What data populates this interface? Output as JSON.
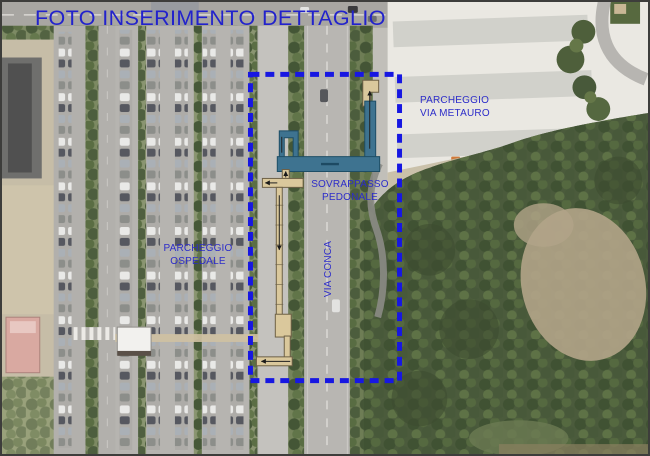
{
  "page": {
    "title": "FOTO INSERIMENTO DETTAGLIO"
  },
  "labels": {
    "parcheggio_via_metauro": {
      "line1": "PARCHEGGIO",
      "line2": "VIA METAURO"
    },
    "sovrappasso_pedonale": {
      "line1": "SOVRAPPASSO",
      "line2": "PEDONALE"
    },
    "parcheggio_ospedale": {
      "line1": "PARCHEGGIO",
      "line2": "OSPEDALE"
    },
    "via_conca": "VIA CONCA"
  },
  "colors": {
    "title_text": "#2222cc",
    "annotation_text": "#2d2dc9",
    "boundary_dash": "#1717e2",
    "overpass_deck": "#3e7390",
    "overpass_ramp": "#dac89c"
  }
}
